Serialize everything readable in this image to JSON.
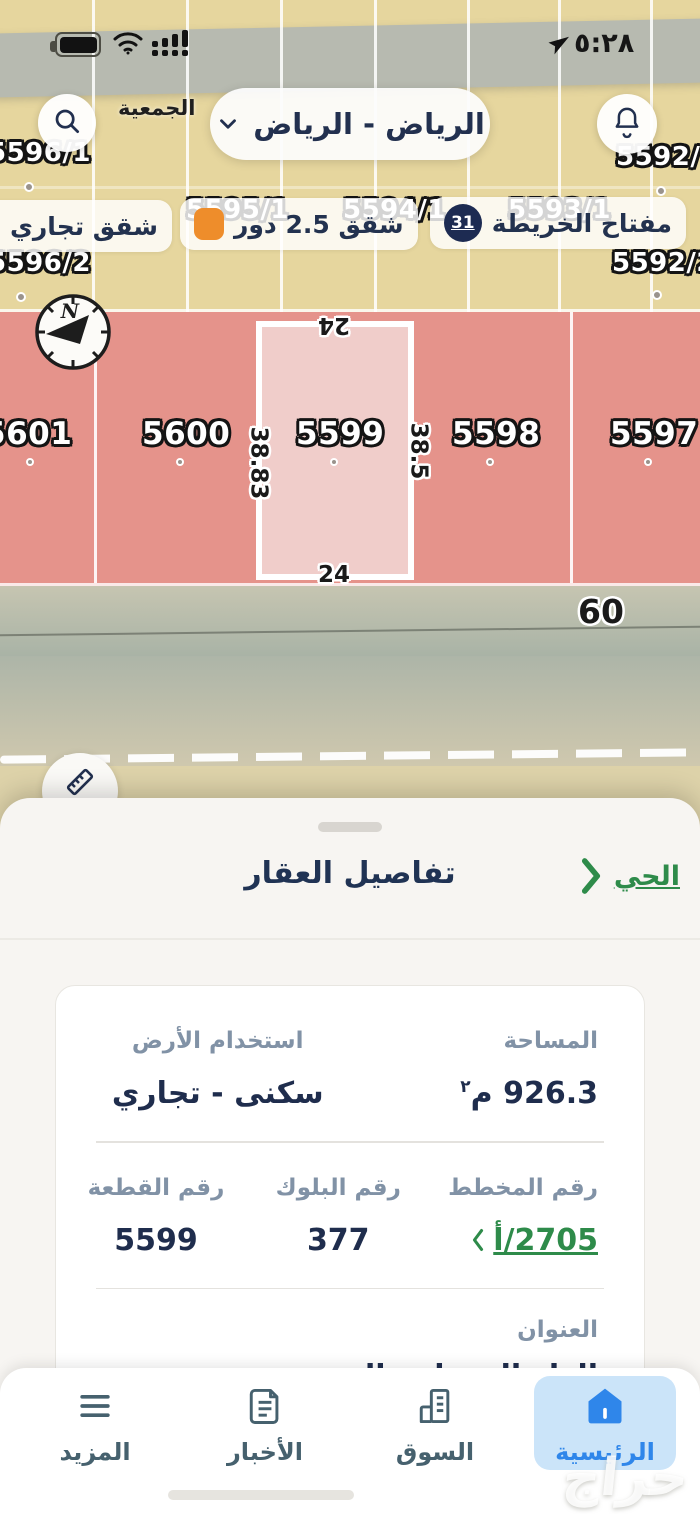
{
  "status_bar": {
    "time": "٥:٢٨"
  },
  "map": {
    "region_selector": {
      "label": "الرياض - الرياض"
    },
    "place_label": "الجمعية",
    "legend": {
      "key": {
        "label": "مفتاح الخريطة",
        "badge": "31",
        "badge_color": "#1d2b52"
      },
      "floors": {
        "label": "شقق 2.5 دور",
        "color": "#ee8d2b"
      },
      "commercial": {
        "label": "شقق تجاري",
        "color": "#f4625e"
      }
    },
    "parcel_labels_top": [
      "5596/1",
      "5592/1",
      "5595/1",
      "5594/1",
      "5593/1",
      "5596/2",
      "5592/2"
    ],
    "plots": [
      "5601",
      "5600",
      "5599",
      "5598",
      "5597"
    ],
    "selected_plot": "5599",
    "compass_letter": "N",
    "dimensions": {
      "top": "24",
      "left": "38.83",
      "right": "38.5",
      "bottom": "24",
      "road_width": "60"
    }
  },
  "sheet": {
    "title": "تفاصيل العقار",
    "district_link": "الحي",
    "card": {
      "area_label": "المساحة",
      "area_value": "926.3",
      "area_unit_base": "م",
      "area_unit_sup": "٢",
      "land_use_label": "استخدام الأرض",
      "land_use_value": "سكنى - تجاري",
      "plan_label": "رقم المخطط",
      "plan_value": "2705/أ",
      "block_label": "رقم البلوك",
      "block_value": "377",
      "piece_label": "رقم القطعة",
      "piece_value": "5599",
      "address_label": "العنوان",
      "address_value": "الدار البيضاء - العزيزية"
    }
  },
  "nav": {
    "items": [
      {
        "label": "الرئيسية",
        "active": true
      },
      {
        "label": "السوق",
        "active": false
      },
      {
        "label": "الأخبار",
        "active": false
      },
      {
        "label": "المزيد",
        "active": false
      }
    ]
  },
  "watermark": "حراج",
  "colors": {
    "accent_blue": "#2f86ea",
    "accent_green": "#2e8b4a",
    "navy": "#1f2d4d",
    "parcel_red": "#e5938b",
    "parcel_selected": "#f0cdca",
    "map_yellow": "#e6d69e"
  }
}
